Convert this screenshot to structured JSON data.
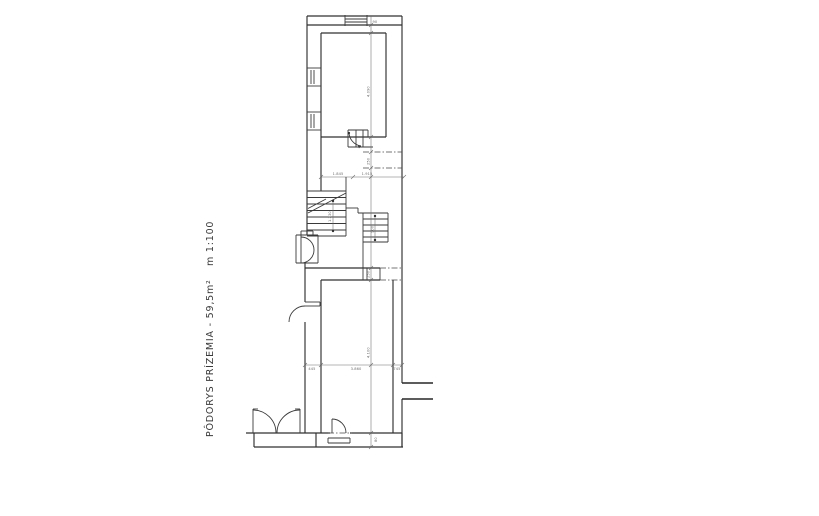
{
  "document": {
    "type": "architectural-floor-plan",
    "language": "Slovak"
  },
  "title": {
    "main": "PÔDORYS PRÍZEMIA - 59,5m²",
    "scale": "m 1:100"
  },
  "colors": {
    "background": "#ffffff",
    "line": "#303030",
    "title_text": "#3a3a3a",
    "dimension_text": "#6b6b6b"
  },
  "dimensions": {
    "top_window": "90",
    "room_top_height": "4.090",
    "door_gap": "250",
    "hall_left": "1.845",
    "hall_right": "1.915",
    "stair_left": "1.230",
    "stair_right": "900",
    "mid_gap": "250",
    "room_bottom_height": "4.100",
    "bottom_door": "80",
    "bottom_left": "445",
    "bottom_mid": "3.860",
    "bottom_right": "745"
  }
}
